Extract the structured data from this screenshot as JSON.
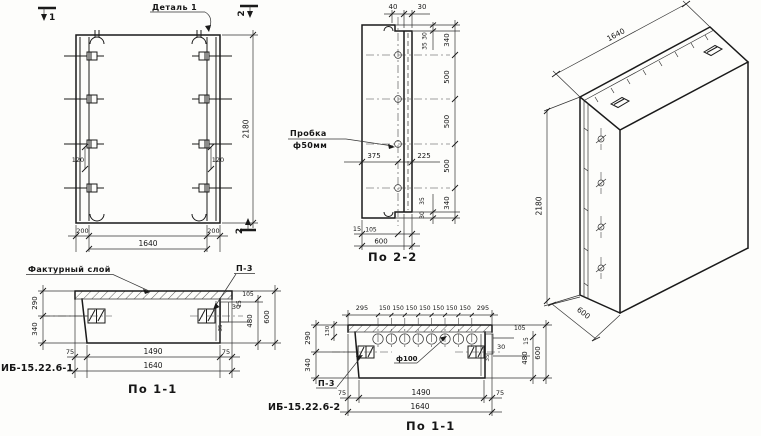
{
  "drawing": {
    "front_view": {
      "detail_callout": "Деталь 1",
      "section_mark_1": "1",
      "section_mark_2_top": "2",
      "section_mark_2_bottom": "2",
      "dim_hook_left": "120",
      "dim_hook_right": "120",
      "dim_bottom_left": "200",
      "dim_bottom_overall": "1640",
      "dim_bottom_right": "200",
      "dim_height": "2180"
    },
    "section_2_2": {
      "title": "По 2-2",
      "plug_callout_line1": "Пробка",
      "plug_callout_line2": "ф50мм",
      "dim_top_40": "40",
      "dim_top_30": "30",
      "dim_right_30_top": "30",
      "dim_right_35_top": "35",
      "dim_seg_340_top": "340",
      "dim_seg_500_1": "500",
      "dim_seg_500_2": "500",
      "dim_seg_500_3": "500",
      "dim_seg_340_bottom": "340",
      "dim_right_35_bottom": "35",
      "dim_right_30_bottom": "30",
      "dim_375": "375",
      "dim_225": "225",
      "dim_15": "15",
      "dim_105": "105",
      "dim_600": "600"
    },
    "plan_view_1": {
      "title": "По 1-1",
      "mark": "ИБ-15.22.6-1",
      "facing_callout": "Фактурный слой",
      "anchor_callout": "П-3",
      "dim_290": "290",
      "dim_340": "340",
      "dim_105": "105",
      "dim_15": "15",
      "dim_30": "30",
      "dim_35": "35",
      "dim_480": "480",
      "dim_600": "600",
      "dim_75_left": "75",
      "dim_1490": "1490",
      "dim_75_right": "75",
      "dim_1640": "1640"
    },
    "plan_view_2": {
      "title": "По 1-1",
      "mark": "ИБ-15.22.6-2",
      "anchor_callout": "П-3",
      "hole_callout": "ф100",
      "dim_295_left": "295",
      "spacings": [
        "150",
        "150",
        "150",
        "150",
        "150",
        "150",
        "150"
      ],
      "dim_295_right": "295",
      "dim_290": "290",
      "dim_130": "130",
      "dim_340": "340",
      "dim_30": "30",
      "dim_35": "35",
      "dim_105": "105",
      "dim_15": "15",
      "dim_480": "480",
      "dim_600": "600",
      "dim_75_left": "75",
      "dim_1490": "1490",
      "dim_75_right": "75",
      "dim_1640": "1640"
    },
    "iso_view": {
      "dim_width": "1640",
      "dim_height": "2180",
      "dim_depth": "600"
    }
  }
}
